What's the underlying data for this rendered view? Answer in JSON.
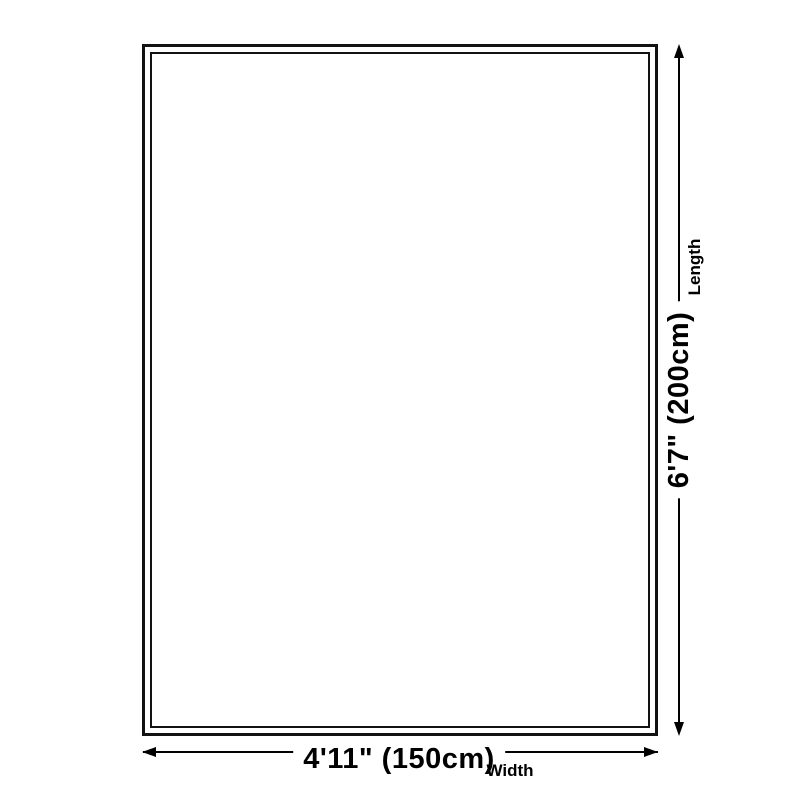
{
  "diagram": {
    "type": "product-dimension-diagram",
    "background_color": "#ffffff",
    "line_color": "#000000",
    "border_color": "#121212",
    "length": {
      "value": "6'7\" (200cm)",
      "label": "Length",
      "cm": 200
    },
    "width": {
      "value": "4'11\" (150cm)",
      "label": "Width",
      "cm": 150
    }
  }
}
